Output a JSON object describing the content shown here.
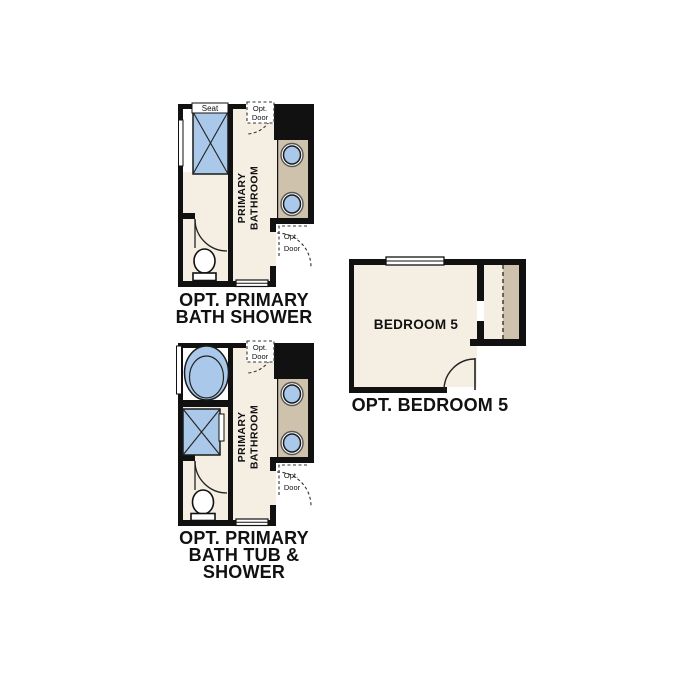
{
  "colors": {
    "wall": "#111111",
    "room_fill": "#f5eee3",
    "fixture_blue": "#aac8e9",
    "counter_tan": "#cfc2ac",
    "label_text": "#111111"
  },
  "plans": {
    "bath_shower": {
      "title_lines": [
        "OPT. PRIMARY",
        "BATH SHOWER"
      ],
      "room_label_lines": [
        "PRIMARY",
        "BATHROOM"
      ],
      "seat_label": "Seat",
      "opt_door_top_lines": [
        "Opt.",
        "Door"
      ],
      "opt_door_bottom_lines": [
        "Opt.",
        "Door"
      ]
    },
    "bath_tub_shower": {
      "title_lines": [
        "OPT. PRIMARY",
        "BATH TUB &",
        "SHOWER"
      ],
      "room_label_lines": [
        "PRIMARY",
        "BATHROOM"
      ],
      "opt_door_top_lines": [
        "Opt.",
        "Door"
      ],
      "opt_door_bottom_lines": [
        "Opt.",
        "Door"
      ]
    },
    "bedroom5": {
      "room_label": "BEDROOM 5",
      "title": "OPT. BEDROOM 5"
    }
  }
}
